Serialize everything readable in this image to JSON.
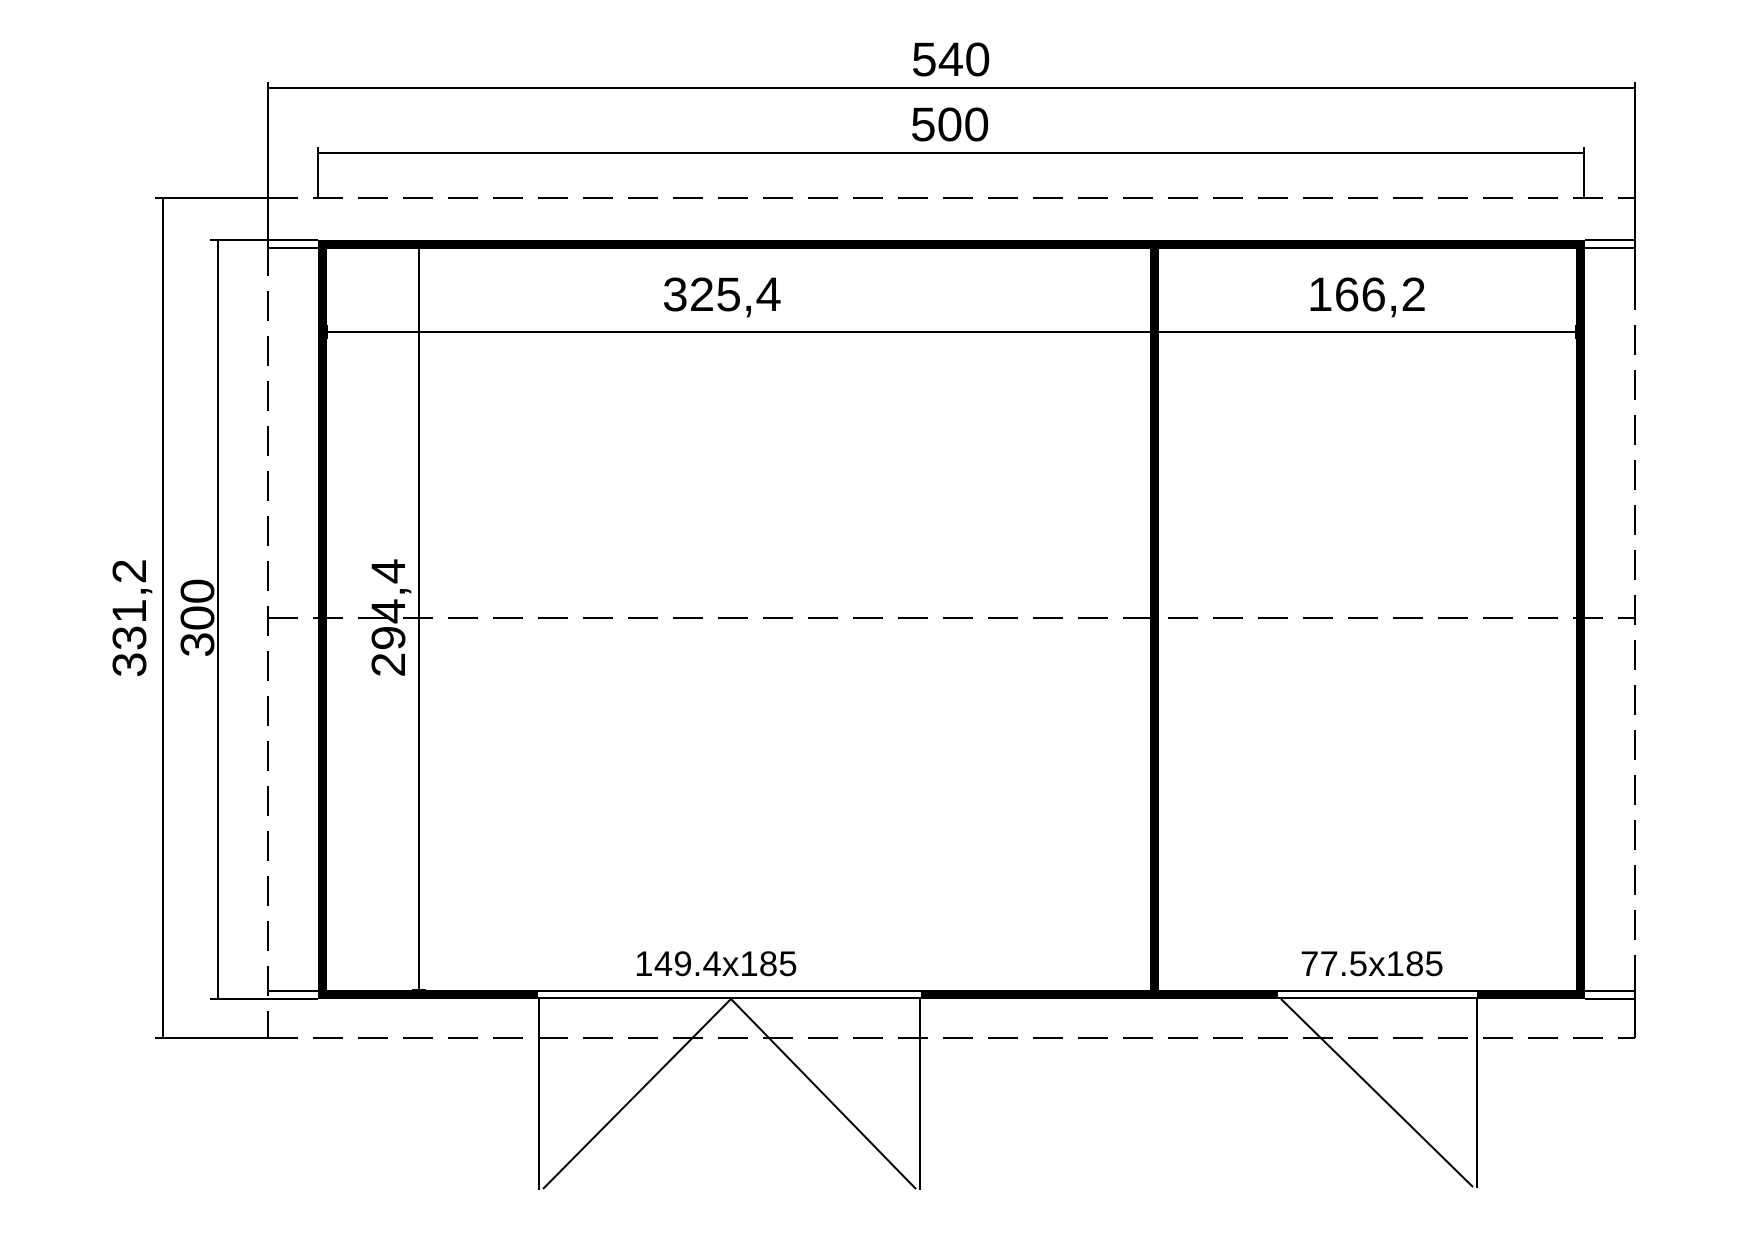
{
  "floor_plan": {
    "colors": {
      "line": "#000000",
      "background": "#ffffff"
    },
    "dimensions": {
      "roof_width": "540",
      "wall_width": "500",
      "roof_depth": "331,2",
      "wall_depth": "300",
      "left_room_width": "325,4",
      "right_room_width": "166,2",
      "room_depth": "294,4"
    },
    "doors": {
      "double_door_label": "149.4x185",
      "single_door_label": "77.5x185"
    }
  }
}
